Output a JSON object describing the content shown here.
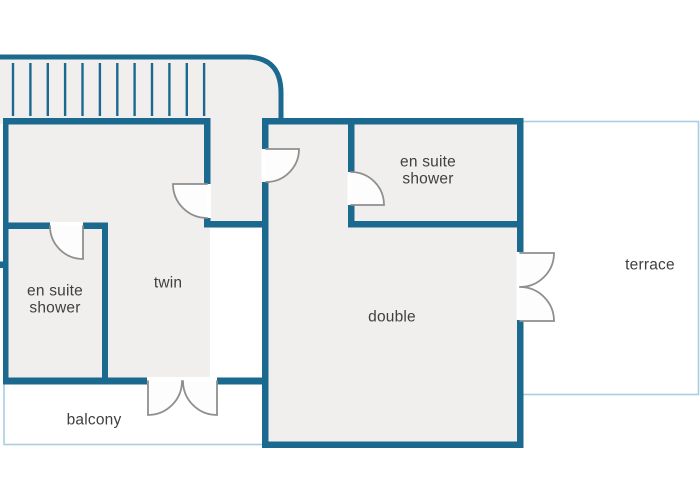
{
  "plan": {
    "rooms": {
      "twin": {
        "label": "twin"
      },
      "double": {
        "label": "double"
      },
      "ensuite_left": {
        "line1": "en suite",
        "line2": "shower"
      },
      "ensuite_right": {
        "line1": "en suite",
        "line2": "shower"
      },
      "balcony": {
        "label": "balcony"
      },
      "terrace": {
        "label": "terrace"
      }
    },
    "stairs": {
      "tick_count": 12
    },
    "colors": {
      "wall": "#1b698f",
      "light_outline": "#a6cfe3",
      "room_fill": "#f0efee",
      "door": "#8f8f8f",
      "text": "#3f3f3f",
      "background": "#ffffff"
    }
  }
}
